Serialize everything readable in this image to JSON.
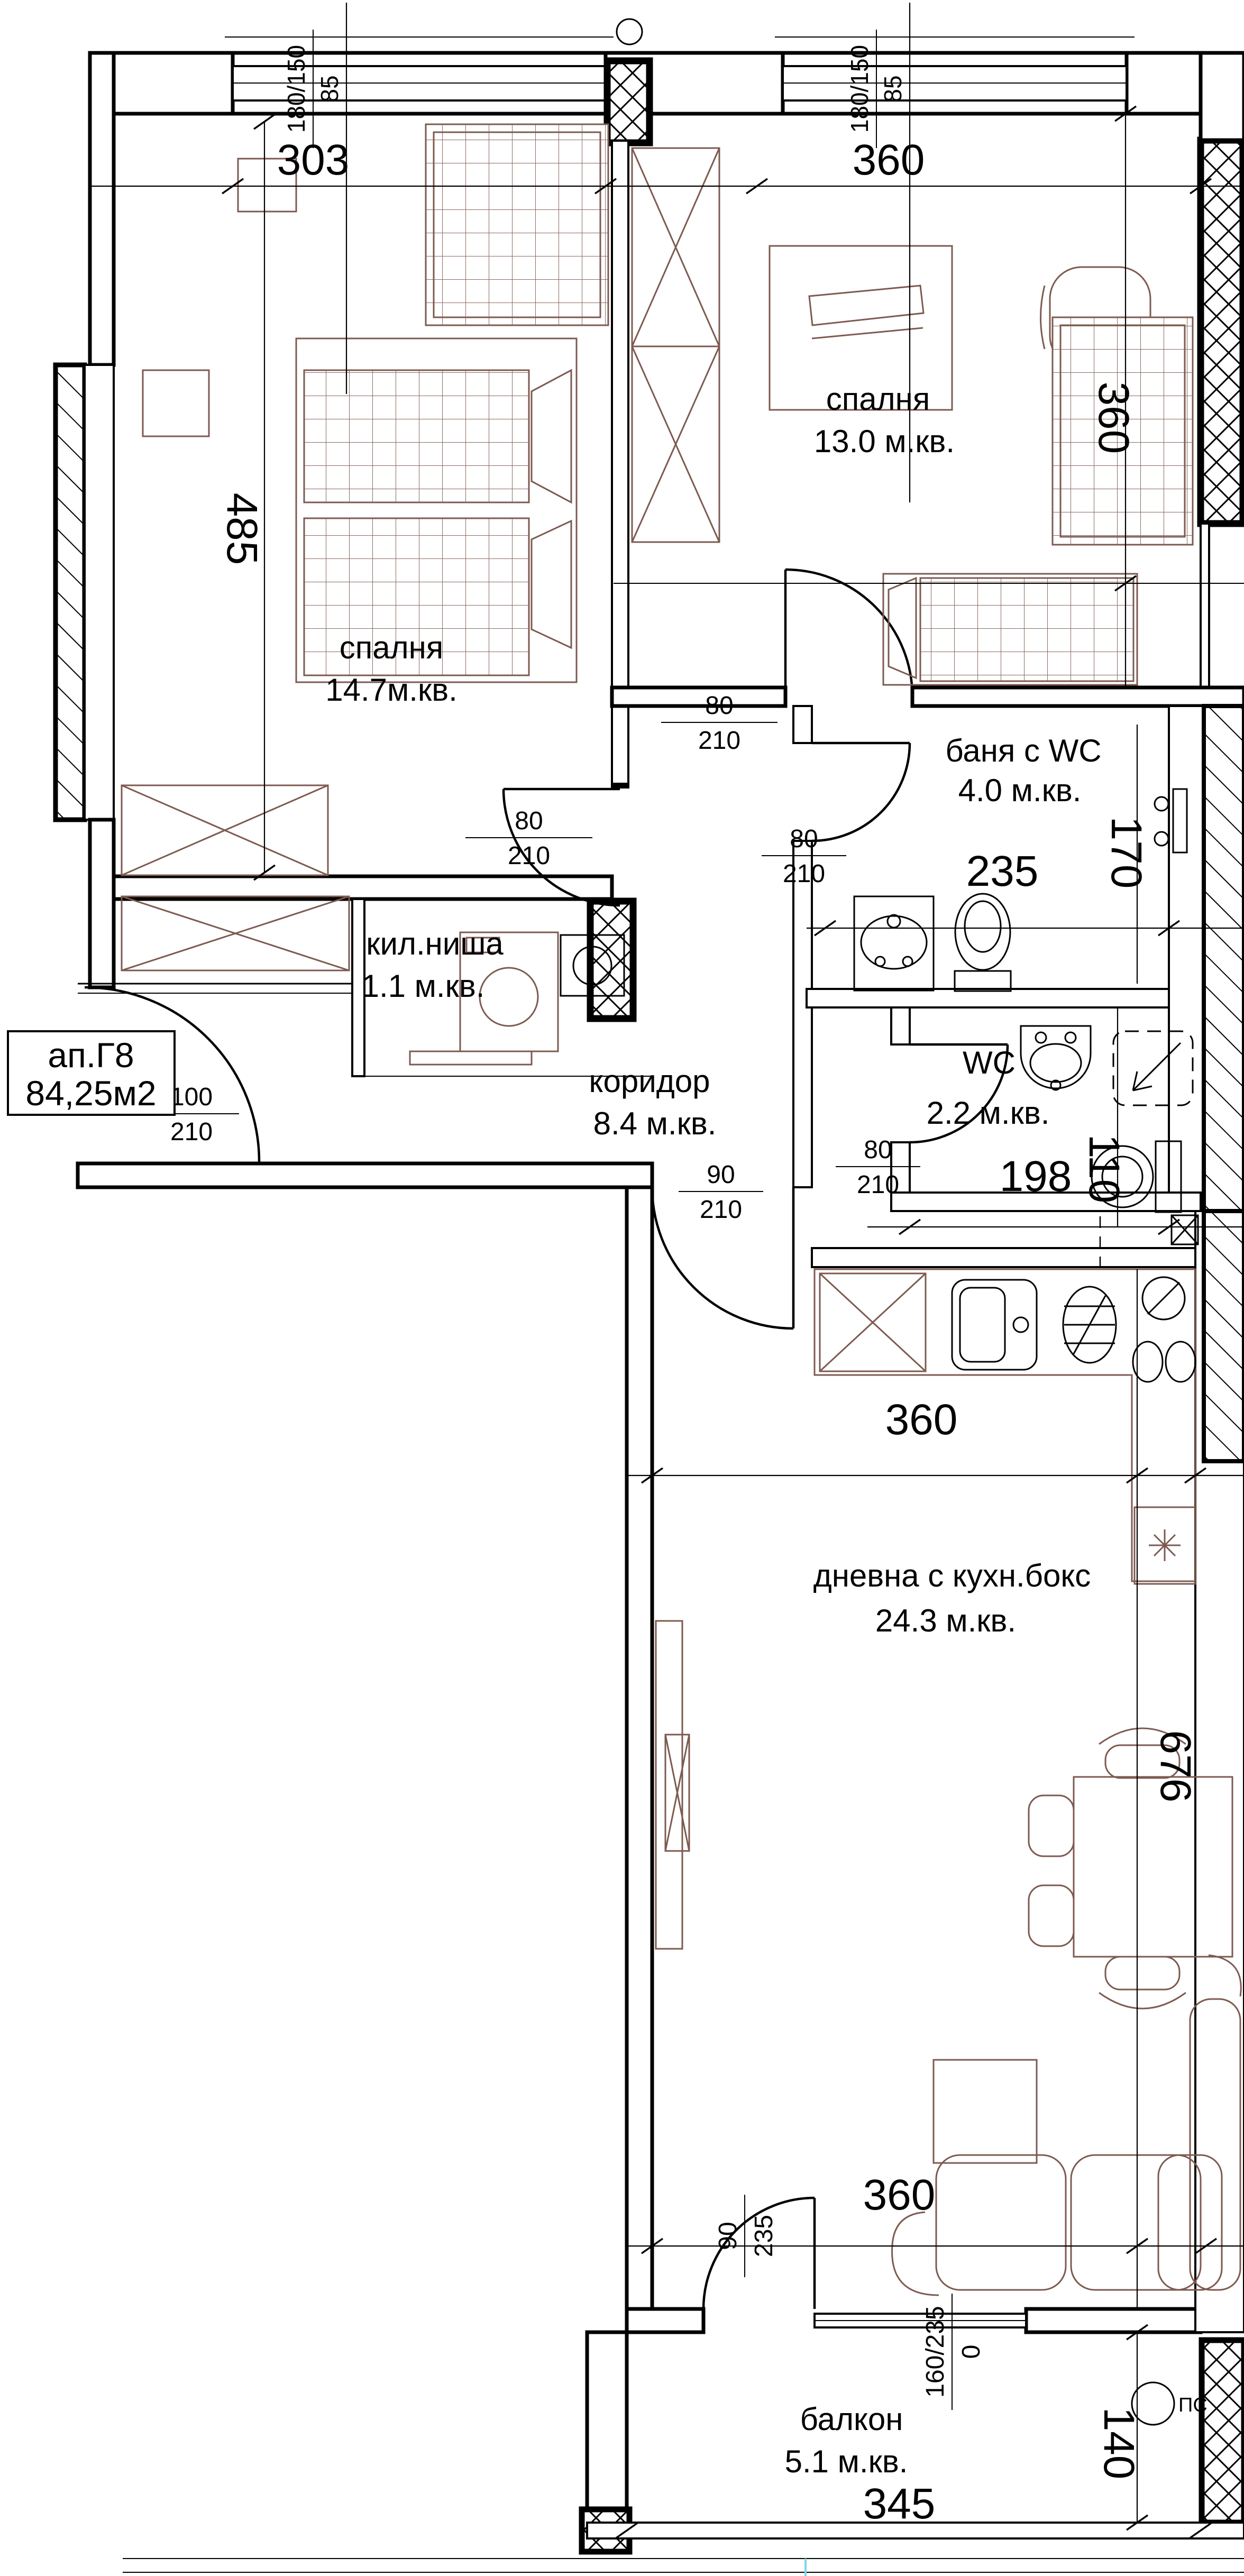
{
  "plan": {
    "apartment": {
      "id": "ап.Г8",
      "area": "84,25м2"
    },
    "rooms": [
      {
        "name": "спалня",
        "area": "14.7м.кв."
      },
      {
        "name": "спалня",
        "area": "13.0 м.кв."
      },
      {
        "name": "баня с WC",
        "area": "4.0 м.кв."
      },
      {
        "name": "кил.ниша",
        "area": "1.1 м.кв."
      },
      {
        "name": "коридор",
        "area": "8.4 м.кв."
      },
      {
        "name": "WC",
        "area": "2.2 м.кв."
      },
      {
        "name": "дневна с кухн.бокс",
        "area": "24.3 м.кв."
      },
      {
        "name": "балкон",
        "area": "5.1 м.кв."
      }
    ],
    "dims": {
      "top_303": "303",
      "top_360": "360",
      "left_485": "485",
      "bedroom2_360": "360",
      "bath_235": "235",
      "bath_170": "170",
      "wc_198": "198",
      "wc_110": "110",
      "living_top_360": "360",
      "living_676": "676",
      "living_bottom_360": "360",
      "balcony_345": "345",
      "balcony_140": "140"
    },
    "frac": {
      "win1": {
        "num": "180/150",
        "den": "85"
      },
      "win2": {
        "num": "180/150",
        "den": "85"
      },
      "door_b1": {
        "num": "80",
        "den": "210"
      },
      "door_b2": {
        "num": "80",
        "den": "210"
      },
      "door_bath": {
        "num": "80",
        "den": "210"
      },
      "door_wc": {
        "num": "80",
        "den": "210"
      },
      "door_ent": {
        "num": "100",
        "den": "210"
      },
      "door_kit": {
        "num": "90",
        "den": "210"
      },
      "door_bal": {
        "num": "90",
        "den": "235"
      },
      "win_bal": {
        "num": "160/235",
        "den": "0"
      }
    },
    "symbols": {
      "ps": "ПС"
    },
    "colors": {
      "walls": "#000000",
      "furniture": "#7d5a50",
      "background": "#ffffff",
      "accent_line": "#7fd6ea"
    }
  }
}
